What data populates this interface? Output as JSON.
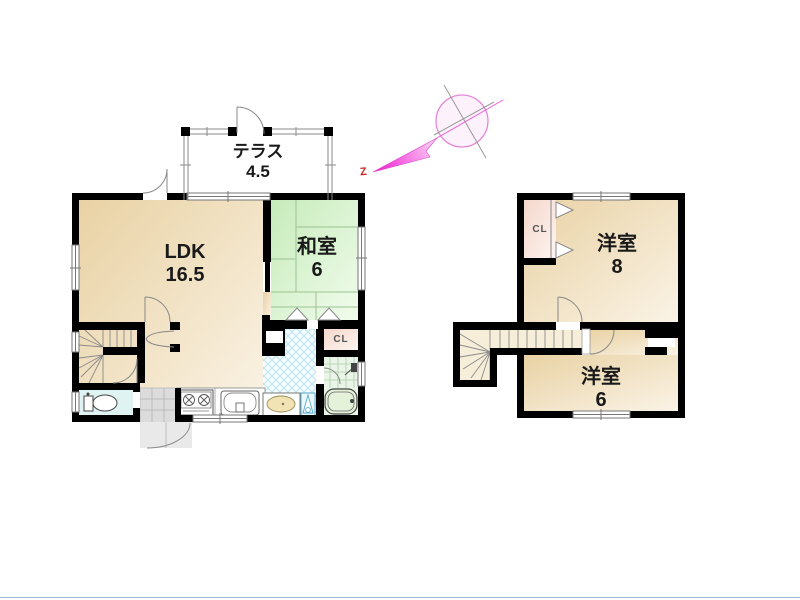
{
  "compass": {
    "north_label": "Z"
  },
  "floor1": {
    "terrace": {
      "name": "テラス",
      "area": "4.5"
    },
    "ldk": {
      "name": "LDK",
      "area": "16.5"
    },
    "japanese_room": {
      "name": "和室",
      "area": "6"
    },
    "closet_label": "CL"
  },
  "floor2": {
    "western_room_large": {
      "name": "洋室",
      "area": "8"
    },
    "western_room_small": {
      "name": "洋室",
      "area": "6"
    },
    "closet_label": "CL"
  },
  "colors": {
    "wall": "#000000",
    "ldk_fill": "#eed9ae",
    "tatami_fill": "#d7f0c9",
    "closet_fill": "#f8e2d7",
    "bath_fill": "#e9f6e7",
    "toilet_fill": "#dff3f3",
    "entrance_fill": "#dcdcdc",
    "washroom_hatch": "#b9e4ef",
    "compass_needle": "#ee22cc",
    "north_letter": "#cc2222"
  }
}
